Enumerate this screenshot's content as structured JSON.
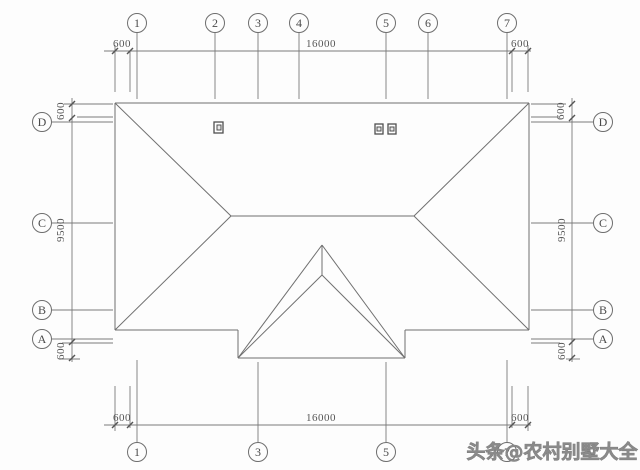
{
  "drawing": {
    "type": "roof-plan",
    "grid_bubbles": {
      "top": [
        "1",
        "2",
        "3",
        "4",
        "5",
        "6",
        "7"
      ],
      "bottom": [
        "1",
        "3",
        "5",
        "7"
      ],
      "left": [
        "D",
        "C",
        "B",
        "A"
      ],
      "right": [
        "D",
        "C",
        "B",
        "A"
      ]
    },
    "dimensions": {
      "top": {
        "left": "600",
        "middle": "16000",
        "right": "600"
      },
      "bottom": {
        "left": "600",
        "middle": "16000",
        "right": "600"
      },
      "left": {
        "top": "600",
        "middle": "9500",
        "bottom": "600"
      },
      "right": {
        "top": "600",
        "middle": "9500",
        "bottom": "600"
      }
    },
    "watermark": "头条@农村别墅大全",
    "colors": {
      "line": "#707070",
      "text": "#565656",
      "watermark": "#8a8a8a",
      "background": "#fdfdfd"
    }
  }
}
